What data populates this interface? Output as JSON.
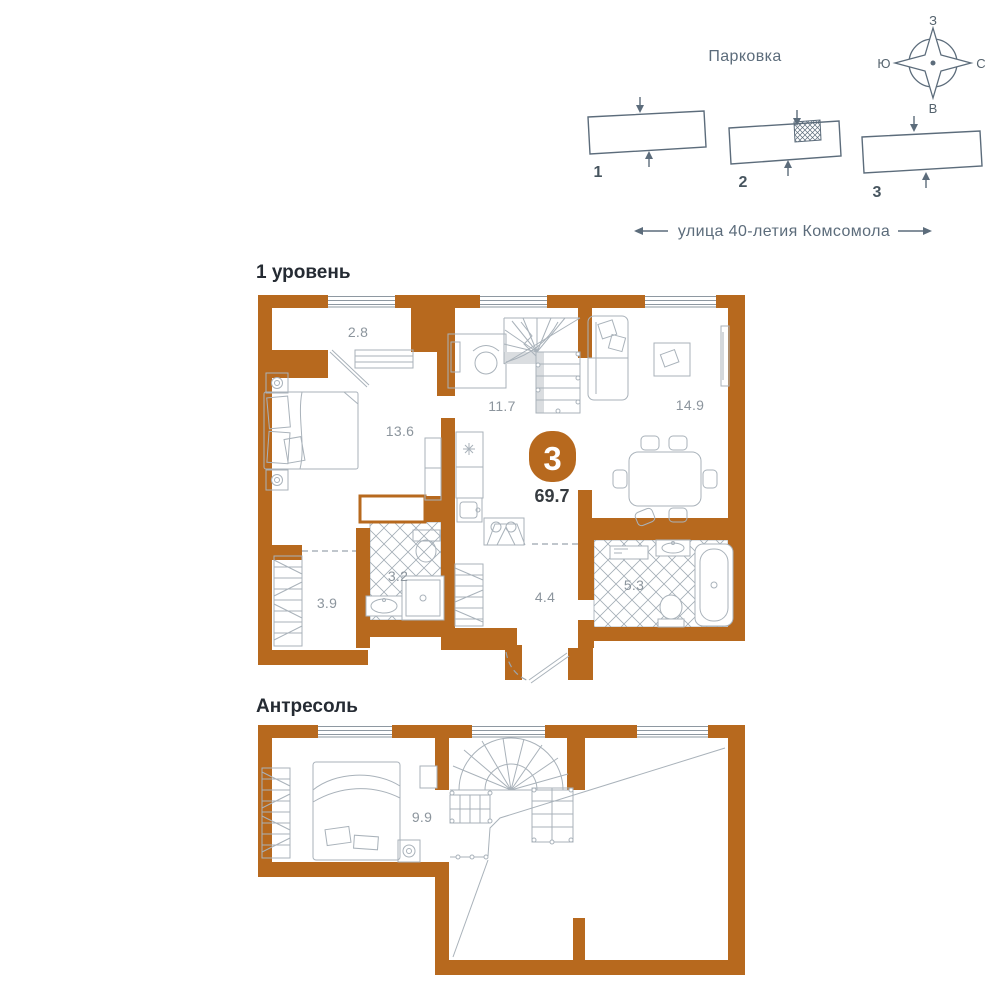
{
  "unit": {
    "rooms_badge": "3",
    "total_area": "69.7"
  },
  "parking": {
    "title": "Парковка",
    "building_labels": [
      "1",
      "2",
      "3"
    ]
  },
  "street": {
    "name": "улица 40-летия Комсомола"
  },
  "compass": {
    "top": "З",
    "left": "Ю",
    "right": "С",
    "bottom": "В"
  },
  "level1": {
    "title": "1 уровень",
    "areas": {
      "balcony": "2.8",
      "bedroom": "13.6",
      "hall": "11.7",
      "living_kitchen": "14.9",
      "bathroom_small": "3.2",
      "wardrobe": "3.9",
      "hallway": "4.4",
      "bathroom": "5.3"
    }
  },
  "mezzanine": {
    "title": "Антресоль",
    "areas": {
      "bedroom": "9.9"
    }
  },
  "colors": {
    "wall_orange": "#b7691e",
    "furniture_line": "#a9b2ba",
    "slate": "#5c6c7b",
    "room_label": "#8c959d",
    "title": "#252b33"
  }
}
